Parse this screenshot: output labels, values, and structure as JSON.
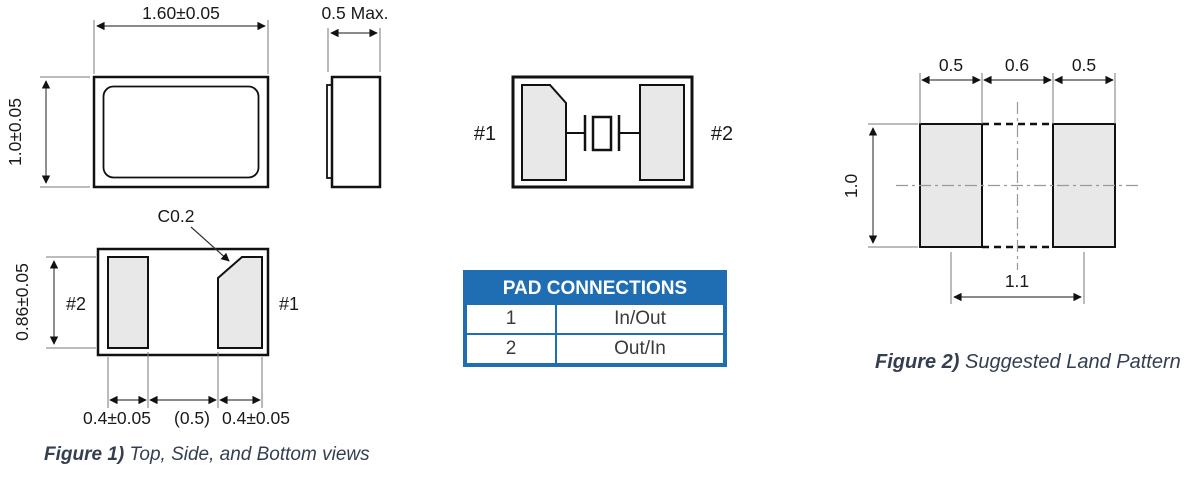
{
  "figure1": {
    "top_view": {
      "width_dim": "1.60±0.05",
      "height_dim": "1.0±0.05"
    },
    "side_view": {
      "width_dim": "0.5 Max."
    },
    "bottom_view": {
      "chamfer_label": "C0.2",
      "left_pad_label": "#2",
      "right_pad_label": "#1",
      "pad_height_dim": "0.86±0.05",
      "left_pad_width_dim": "0.4±0.05",
      "gap_dim": "(0.5)",
      "right_pad_width_dim": "0.4±0.05"
    },
    "caption": {
      "bold": "Figure 1)",
      "text": " Top, Side, and Bottom views"
    }
  },
  "schematic": {
    "left_pad_label": "#1",
    "right_pad_label": "#2"
  },
  "pad_connections": {
    "title": "PAD CONNECTIONS",
    "rows": [
      {
        "pad": "1",
        "connection": "In/Out"
      },
      {
        "pad": "2",
        "connection": "Out/In"
      }
    ]
  },
  "figure2": {
    "land_pattern": {
      "left_pad_width_dim": "0.5",
      "gap_dim": "0.6",
      "right_pad_width_dim": "0.5",
      "height_dim": "1.0",
      "pitch_dim": "1.1"
    },
    "caption": {
      "bold": "Figure 2)",
      "text": " Suggested Land Pattern"
    }
  },
  "colors": {
    "table_blue": "#1F6EB3",
    "pad_fill": "#E8E8E8",
    "outline": "#111111",
    "caption_text": "#333F50"
  }
}
